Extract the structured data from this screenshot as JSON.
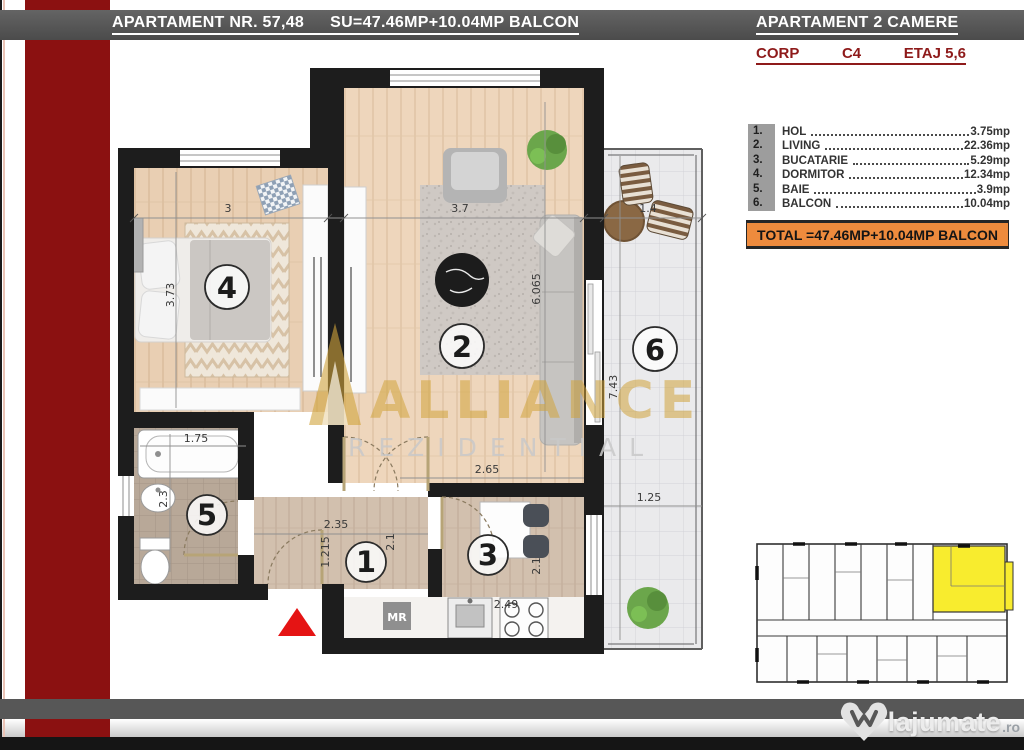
{
  "header": {
    "left_title": "APARTAMENT NR. 57,48",
    "left_surface": "SU=47.46MP+10.04MP BALCON",
    "right_title": "APARTAMENT 2 CAMERE",
    "corp_label": "CORP",
    "corp_value": "C4",
    "floor_label": "ETAJ 5,6"
  },
  "legend": {
    "items": [
      {
        "no": "1.",
        "name": "HOL",
        "value": "3.75mp"
      },
      {
        "no": "2.",
        "name": "LIVING",
        "value": "22.36mp"
      },
      {
        "no": "3.",
        "name": "BUCATARIE",
        "value": "5.29mp"
      },
      {
        "no": "4.",
        "name": "DORMITOR",
        "value": "12.34mp"
      },
      {
        "no": "5.",
        "name": "BAIE",
        "value": "3.9mp"
      },
      {
        "no": "6.",
        "name": "BALCON",
        "value": "10.04mp"
      }
    ],
    "total": "TOTAL =47.46MP+10.04MP BALCON"
  },
  "plan": {
    "room_numbers": [
      "1",
      "2",
      "3",
      "4",
      "5",
      "6"
    ],
    "dims": {
      "bedroom_w": "3",
      "bedroom_h": "3.73",
      "living_w": "3.7",
      "living_h": "6.065",
      "balcony_w": "1.4",
      "balcony_h": "7.43",
      "balcony_b": "1.25",
      "bath_w": "1.75",
      "bath_h": "2.3",
      "hall_w": "2.35",
      "hall_h": "1.215",
      "hall_r": "2.1",
      "kitchen_w": "2.65",
      "kitchen_h": "2.1",
      "kitchen_b": "2.49"
    },
    "shaft_label": "MR",
    "watermark_line1": "ALLIANCE",
    "watermark_line2": "REZIDENTIAL"
  },
  "footer": {
    "logo_text": "lajumate",
    "logo_tld": ".ro"
  },
  "colors": {
    "accent_red": "#8b1111",
    "band_gray": "#575757",
    "total_orange": "#ee8b3d",
    "highlight_yellow": "#f8ec2e",
    "entrance_red": "#e51414",
    "watermark_gold": "#d1a43c"
  }
}
